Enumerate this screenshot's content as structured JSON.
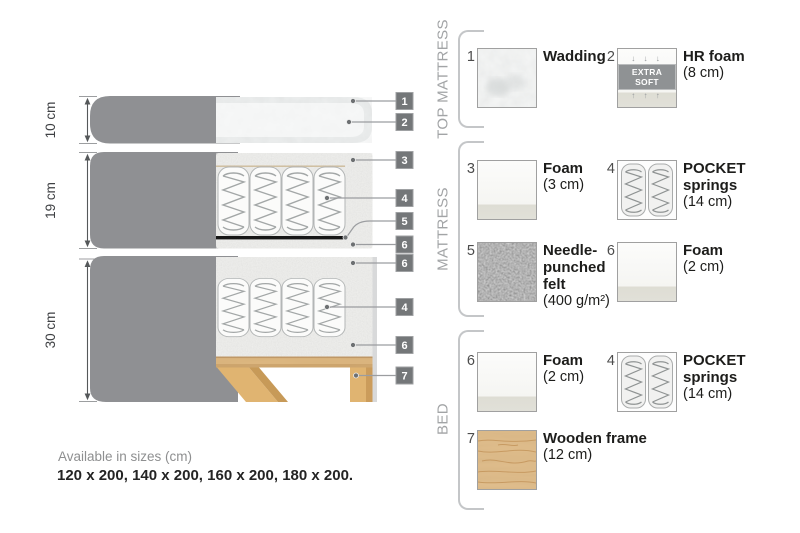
{
  "diagram": {
    "dims": [
      "10 cm",
      "19 cm",
      "30 cm"
    ],
    "badges": [
      "1",
      "2",
      "3",
      "4",
      "5",
      "6",
      "6",
      "4",
      "6",
      "7"
    ]
  },
  "legend": {
    "sections": [
      {
        "title": "TOP MATTRESS",
        "items": [
          {
            "num": "1",
            "name": "Wadding",
            "size": ""
          },
          {
            "num": "2",
            "name": "HR foam",
            "size": "(8 cm)",
            "swatch_label": "EXTRA SOFT",
            "arrows_down": "↓ ↓ ↓",
            "arrows_up": "↑ ↑ ↑"
          }
        ]
      },
      {
        "title": "MATTRESS",
        "items": [
          {
            "num": "3",
            "name": "Foam",
            "size": "(3 cm)"
          },
          {
            "num": "4",
            "name": "POCKET springs",
            "size": "(14 cm)"
          },
          {
            "num": "5",
            "name": "Needle-punched felt",
            "size": "(400 g/m²)"
          },
          {
            "num": "6",
            "name": "Foam",
            "size": "(2 cm)"
          }
        ]
      },
      {
        "title": "BED",
        "items": [
          {
            "num": "6",
            "name": "Foam",
            "size": "(2 cm)"
          },
          {
            "num": "4",
            "name": "POCKET springs",
            "size": "(14 cm)"
          },
          {
            "num": "7",
            "name": "Wooden frame",
            "size": "(12 cm)"
          }
        ]
      }
    ]
  },
  "footer": {
    "sizes_title": "Available in sizes (cm)",
    "sizes_values": "120 x 200, 140 x 200, 160 x 200, 180 x 200."
  },
  "colors": {
    "fabric_gray": "#8f9093",
    "badge_gray": "#747779",
    "wood": "#ddb06a",
    "felt": "#6e6e6e",
    "text_dark": "#1d1d1b",
    "muted": "#a2a4a6"
  }
}
